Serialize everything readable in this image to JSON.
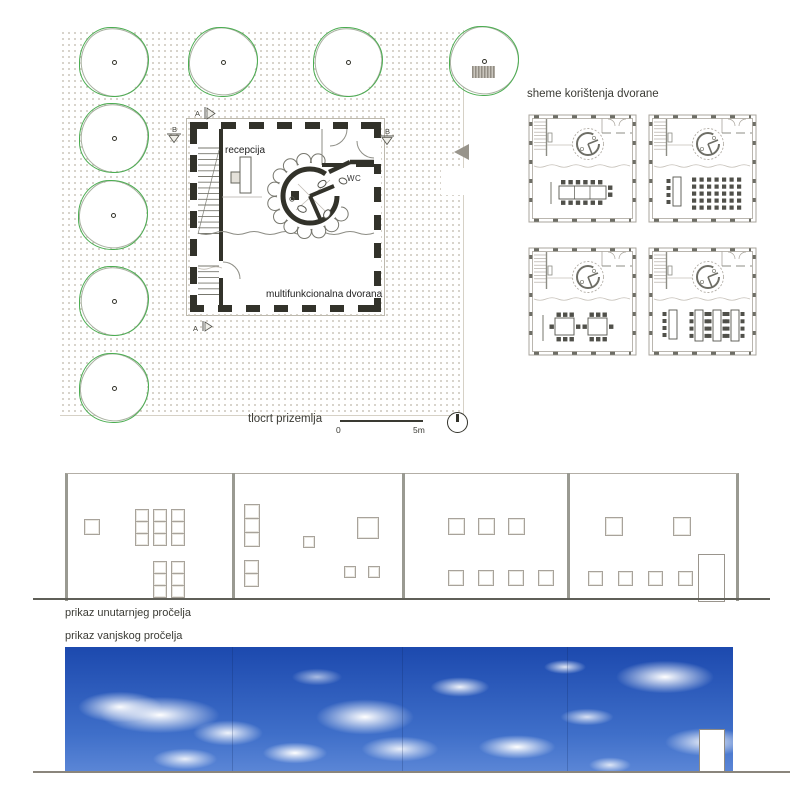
{
  "colors": {
    "tree_green": "#4bad51",
    "wall_dark": "#32322a",
    "dot_gray": "#b5ad9e",
    "sky_blue_top": "#1c49ae",
    "sky_blue_bottom": "#5b86d6",
    "drawing_gray": "#9a9a92",
    "text": "#3b3b35"
  },
  "site_plan": {
    "caption": "tlocrt prizemlja",
    "labels": {
      "reception": "recepcija",
      "wc": "WC",
      "hall": "multifunkcionalna dvorana"
    },
    "section_a": "A",
    "section_b": "B",
    "scale_start": "0",
    "scale_end": "5m",
    "trees": [
      {
        "x": 114,
        "y": 62
      },
      {
        "x": 223,
        "y": 62
      },
      {
        "x": 348,
        "y": 62
      },
      {
        "x": 484,
        "y": 61
      },
      {
        "x": 114,
        "y": 138
      },
      {
        "x": 113,
        "y": 215
      },
      {
        "x": 114,
        "y": 301
      },
      {
        "x": 114,
        "y": 388
      }
    ]
  },
  "schemes": {
    "title": "sheme korištenja dvorane",
    "variants": [
      "banquet",
      "theatre",
      "meeting-tables",
      "classroom"
    ]
  },
  "interior_elevation": {
    "caption": "prikaz unutarnjeg pročelja",
    "dividers_x": [
      232,
      402,
      567
    ],
    "windows": [
      [
        84,
        519,
        14,
        14
      ],
      [
        135,
        509,
        12,
        11
      ],
      [
        153,
        509,
        12,
        11
      ],
      [
        171,
        509,
        12,
        11
      ],
      [
        135,
        521,
        12,
        11
      ],
      [
        153,
        521,
        12,
        11
      ],
      [
        171,
        521,
        12,
        11
      ],
      [
        135,
        533,
        12,
        11
      ],
      [
        153,
        533,
        12,
        11
      ],
      [
        171,
        533,
        12,
        11
      ],
      [
        153,
        561,
        12,
        11
      ],
      [
        171,
        561,
        12,
        11
      ],
      [
        153,
        573,
        12,
        11
      ],
      [
        171,
        573,
        12,
        11
      ],
      [
        153,
        585,
        12,
        11
      ],
      [
        171,
        585,
        12,
        11
      ],
      [
        244,
        504,
        14,
        13
      ],
      [
        244,
        518,
        14,
        13
      ],
      [
        244,
        532,
        14,
        13
      ],
      [
        244,
        560,
        13,
        12
      ],
      [
        244,
        573,
        13,
        12
      ],
      [
        303,
        536,
        10,
        10
      ],
      [
        357,
        517,
        20,
        20
      ],
      [
        344,
        566,
        10,
        10
      ],
      [
        368,
        566,
        10,
        10
      ],
      [
        448,
        518,
        15,
        15
      ],
      [
        478,
        518,
        15,
        15
      ],
      [
        508,
        518,
        15,
        15
      ],
      [
        448,
        570,
        14,
        14
      ],
      [
        478,
        570,
        14,
        14
      ],
      [
        508,
        570,
        14,
        14
      ],
      [
        538,
        570,
        14,
        14
      ],
      [
        605,
        517,
        16,
        17
      ],
      [
        673,
        517,
        16,
        17
      ],
      [
        588,
        571,
        13,
        13
      ],
      [
        618,
        571,
        13,
        13
      ],
      [
        648,
        571,
        13,
        13
      ],
      [
        678,
        571,
        13,
        13
      ]
    ],
    "door": {
      "x": 698,
      "y": 554,
      "w": 25,
      "h": 46
    }
  },
  "exterior_elevation": {
    "caption": "prikaz vanjskog pročelja",
    "door": {
      "x": 699,
      "y": 729,
      "w": 24,
      "h": 42
    }
  }
}
